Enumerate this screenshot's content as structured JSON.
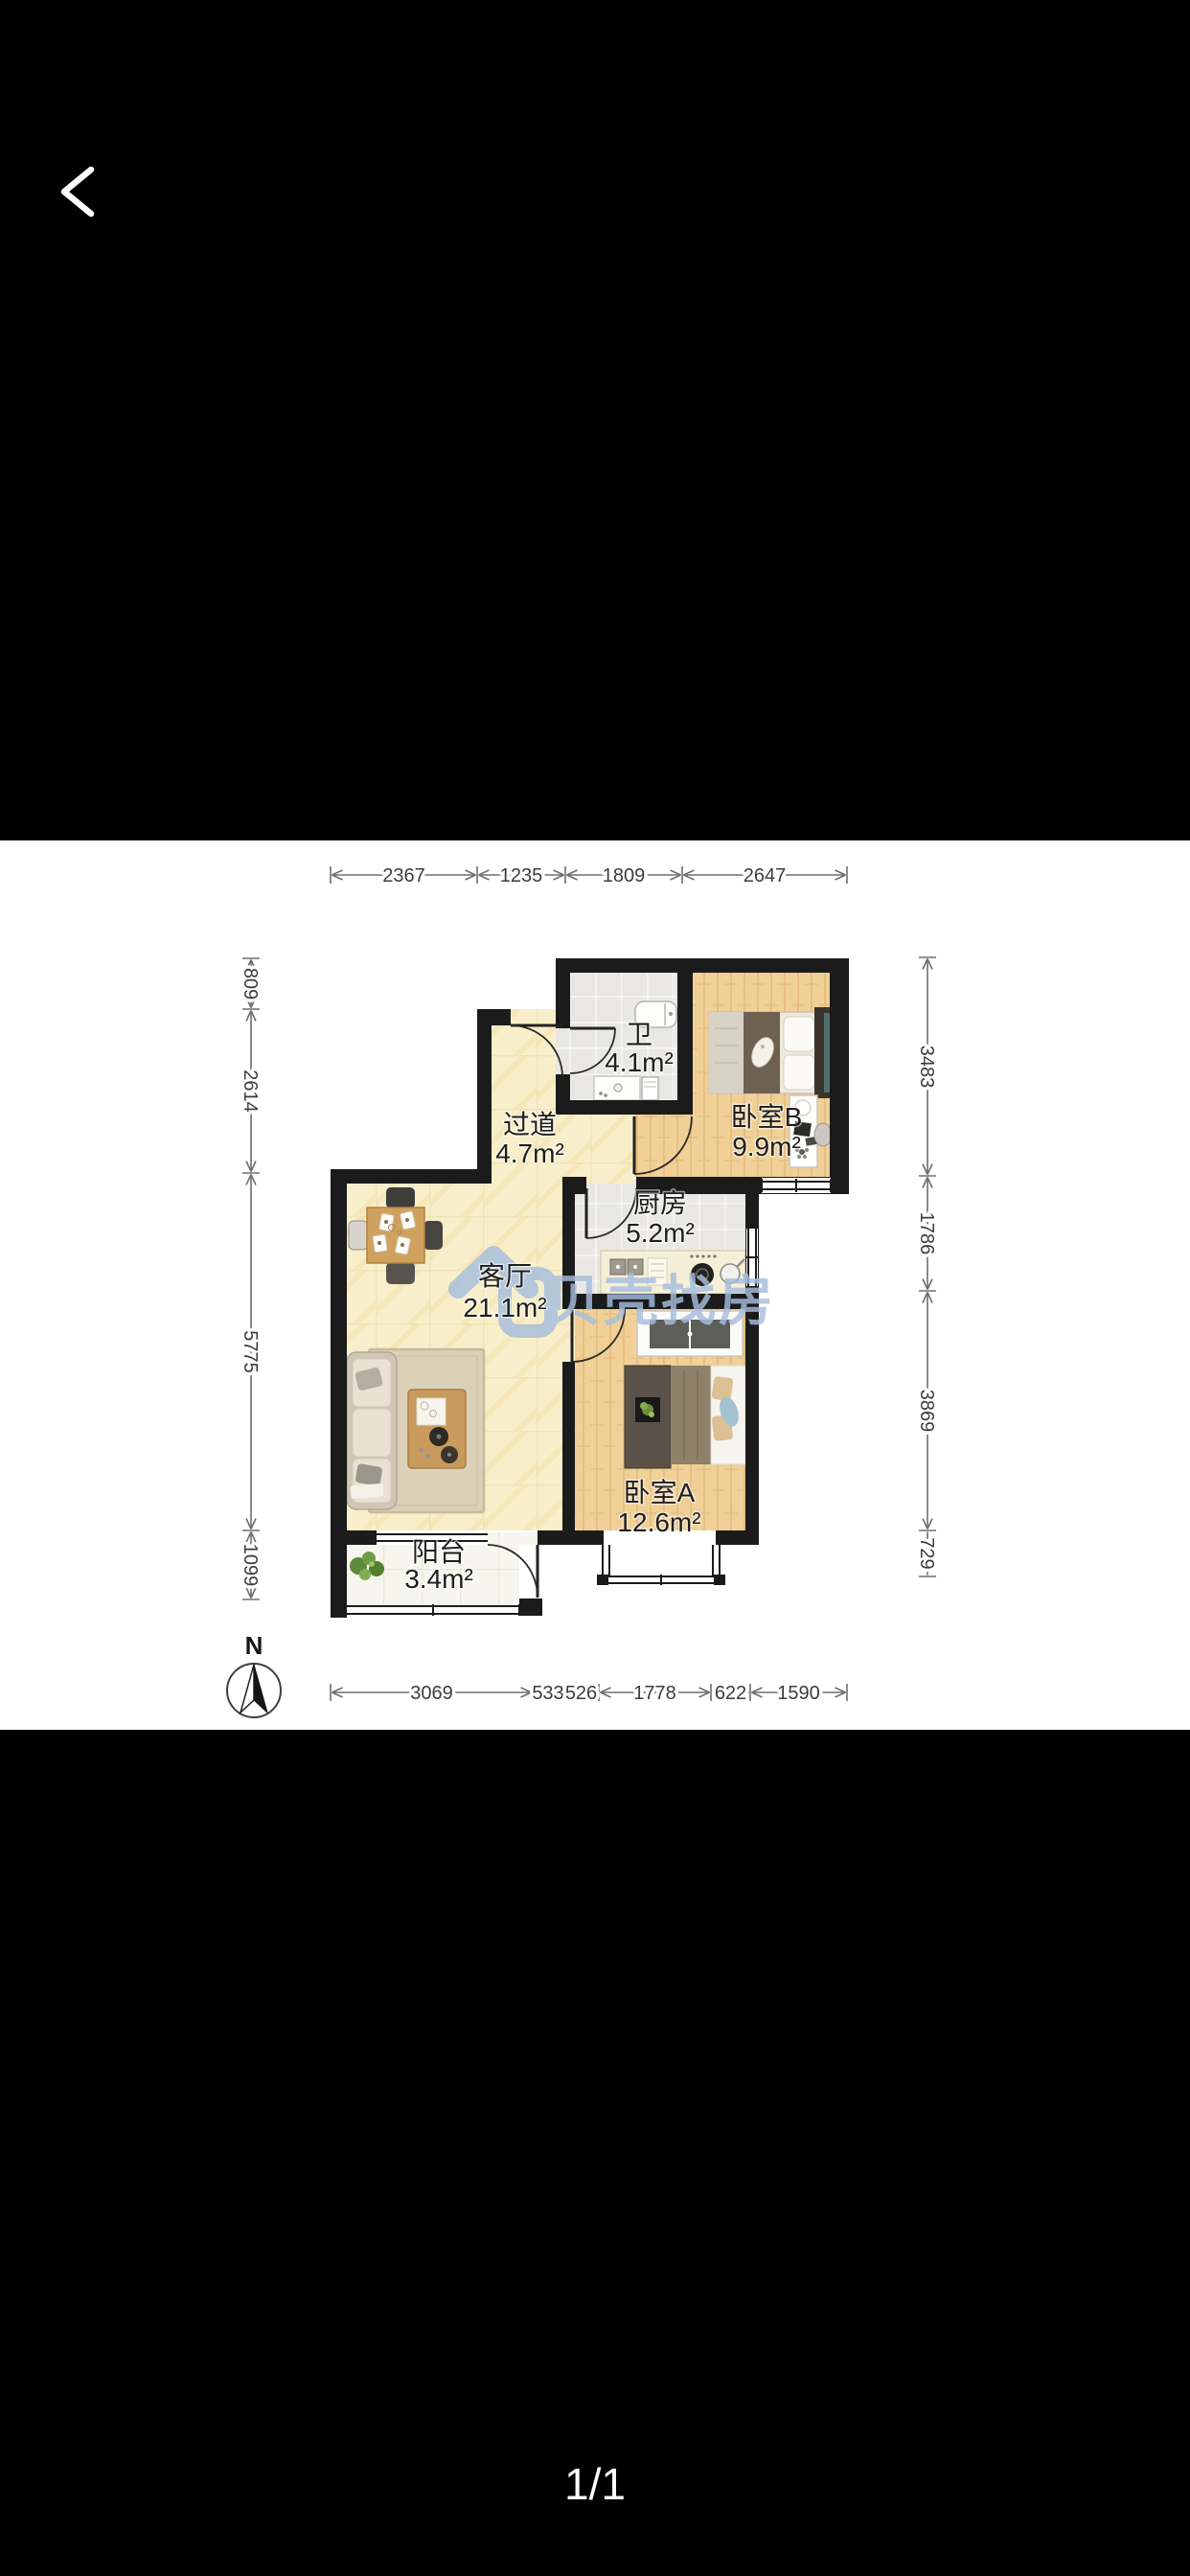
{
  "header": {
    "back_icon": "chevron-left"
  },
  "viewer": {
    "page_indicator": "1/1"
  },
  "floorplan": {
    "watermark": {
      "logo": "beike-house-logo",
      "text": "贝壳找房"
    },
    "compass": {
      "north_label": "N"
    },
    "rooms": [
      {
        "id": "bathroom",
        "name": "卫",
        "area": "4.1m²"
      },
      {
        "id": "bedroom-b",
        "name": "卧室B",
        "area": "9.9m²"
      },
      {
        "id": "hallway",
        "name": "过道",
        "area": "4.7m²"
      },
      {
        "id": "kitchen",
        "name": "厨房",
        "area": "5.2m²"
      },
      {
        "id": "living-room",
        "name": "客厅",
        "area": "21.1m²"
      },
      {
        "id": "bedroom-a",
        "name": "卧室A",
        "area": "12.6m²"
      },
      {
        "id": "balcony",
        "name": "阳台",
        "area": "3.4m²"
      }
    ],
    "dimensions_mm": {
      "top": [
        "2367",
        "1235",
        "1809",
        "2647"
      ],
      "left": [
        "809",
        "2614",
        "5775",
        "1099"
      ],
      "right": [
        "3483",
        "1786",
        "3869",
        "729"
      ],
      "bottom": [
        "3069",
        "533",
        "526",
        "1778",
        "622",
        "1590"
      ]
    },
    "colors": {
      "background": "#000000",
      "canvas": "#ffffff",
      "wall": "#1b1b1b",
      "floor_cream": "#f8efca",
      "floor_wood": "#f0d096",
      "floor_tile": "#e8e7e3",
      "watermark_blue": "#a6bedd"
    }
  }
}
